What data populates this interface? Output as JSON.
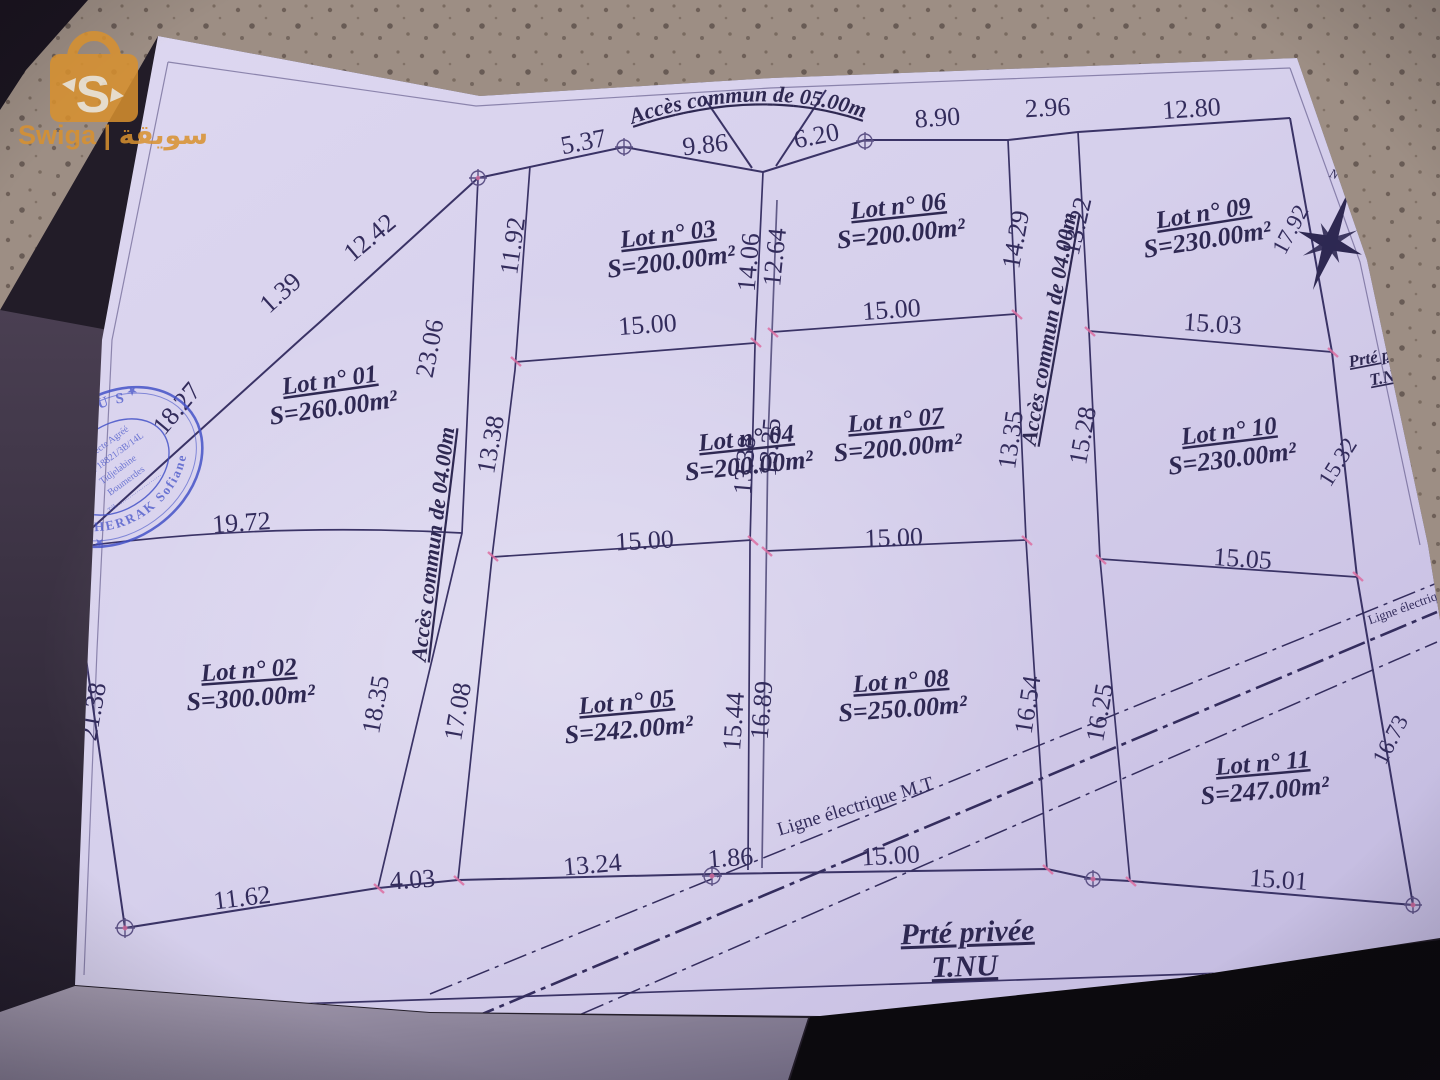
{
  "watermark": {
    "brand": "Swiga | سويقة",
    "logo_letter": "S"
  },
  "stamp": {
    "arc_top": "BAAMUS",
    "arc_bottom": "GHERRAK Sofiane",
    "line1": "Architecte Agréé",
    "line2": "ODA: 18821/3B/14L",
    "line3": "Tidjelabine",
    "line4": "Boumerdes",
    "line5": "Tél. ……………………",
    "star": "★"
  },
  "compass": {
    "north": "N"
  },
  "plan": {
    "access_top": "Accès commun de 05.00m",
    "access_left": "Accès commun de 04.00m",
    "access_right": "Accès commun de 04.00m",
    "power_line": "Ligne électrique M.T",
    "power_line_right": "Ligne électriq",
    "road_bottom_1": "Prté privée",
    "road_bottom_2": "T.NU",
    "road_right_1": "Prté privée",
    "road_right_2": "T.NU",
    "neighbor_a": "s Ahl",
    "neighbor_b": "tia",
    "neighbor_c": "privée",
    "lots": [
      {
        "name": "Lot n° 01",
        "area": "S=260.00m²"
      },
      {
        "name": "Lot n° 02",
        "area": "S=300.00m²"
      },
      {
        "name": "Lot n° 03",
        "area": "S=200.00m²"
      },
      {
        "name": "Lot n° 04",
        "area": "S=200.00m²"
      },
      {
        "name": "Lot n° 05",
        "area": "S=242.00m²"
      },
      {
        "name": "Lot n° 06",
        "area": "S=200.00m²"
      },
      {
        "name": "Lot n° 07",
        "area": "S=200.00m²"
      },
      {
        "name": "Lot n° 08",
        "area": "S=250.00m²"
      },
      {
        "name": "Lot n° 09",
        "area": "S=230.00m²"
      },
      {
        "name": "Lot n° 10",
        "area": "S=230.00m²"
      },
      {
        "name": "Lot n° 11",
        "area": "S=247.00m²"
      }
    ],
    "dims": [
      "5.37",
      "9.86",
      "6.20",
      "8.90",
      "2.96",
      "12.80",
      "1.39",
      "12.42",
      "18.27",
      "11.92",
      "23.06",
      "13.38",
      "14.06",
      "12.64",
      "14.29",
      "13.22",
      "15.00",
      "15.00",
      "15.03",
      "13.38",
      "13.35",
      "13.35",
      "15.28",
      "15.00",
      "15.00",
      "15.05",
      "19.72",
      "21.38",
      "18.35",
      "17.08",
      "15.44",
      "16.89",
      "16.54",
      "16.25",
      "17.92",
      "15.32",
      "16.73",
      "11.62",
      "4.03",
      "13.24",
      "1.86",
      "15.00",
      "15.01"
    ]
  }
}
